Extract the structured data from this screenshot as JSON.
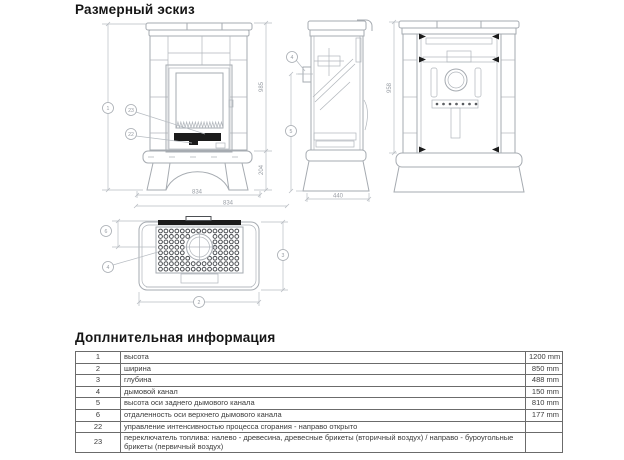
{
  "sketch": {
    "title": "Размерный эскиз",
    "dims": {
      "front_body_height": "985",
      "front_leg_height": "204",
      "front_width": "834",
      "side_depth": "440",
      "rear_height": "958",
      "top_width": "834"
    },
    "callouts": {
      "n1": "1",
      "n2": "2",
      "n3": "3",
      "n4": "4",
      "n5": "5",
      "n6": "6",
      "n22": "22",
      "n23": "23"
    }
  },
  "info": {
    "title": "Доплнительная информация",
    "rows": [
      {
        "num": "1",
        "desc": "высота",
        "value": "1200 mm"
      },
      {
        "num": "2",
        "desc": "ширина",
        "value": "850 mm"
      },
      {
        "num": "3",
        "desc": "глубина",
        "value": "488 mm"
      },
      {
        "num": "4",
        "desc": "дымовой канал",
        "value": "150 mm"
      },
      {
        "num": "5",
        "desc": "высота оси заднего дымового канала",
        "value": "810 mm"
      },
      {
        "num": "6",
        "desc": "отдаленность оси верхнего дымового канала",
        "value": "177 mm"
      },
      {
        "num": "22",
        "desc": "управление интенсивностью процесса сгорания - направо открыто",
        "value": ""
      },
      {
        "num": "23",
        "desc": "переключатель топлива: налево - древесина, древесные брикеты (вторичный воздух) / направо - буроугольные брикеты (первичный воздух)",
        "value": ""
      }
    ]
  },
  "colors": {
    "drawing_line": "#a6abb1",
    "dark_detail": "#1c1c1c",
    "table_border": "#6b6b6b",
    "text": "#3b3b3b"
  }
}
